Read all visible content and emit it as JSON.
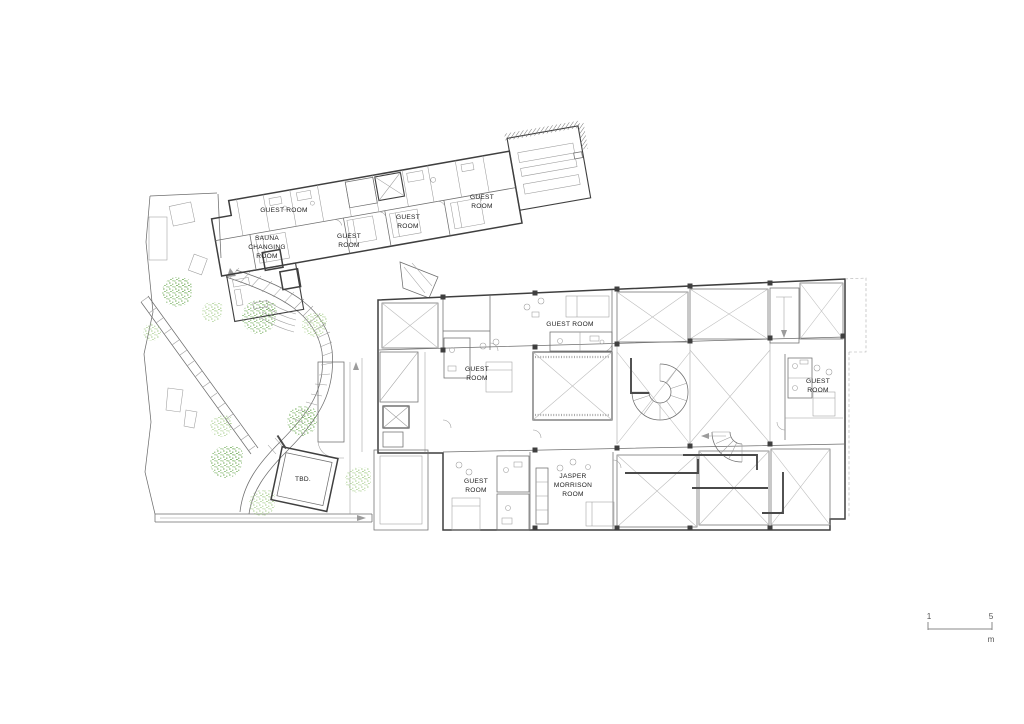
{
  "palette": {
    "wall": "#3f3f3f",
    "medium": "#6e6e6e",
    "light": "#9c9c9c",
    "brace": "#bdbdbd",
    "tree_mid": "#74ae5c",
    "tree_light": "#a9cf8f",
    "text": "#1c1c1c",
    "scale": "#555555"
  },
  "room_labels": [
    {
      "id": "upper-guest-room-1",
      "lines": [
        "GUEST ROOM"
      ]
    },
    {
      "id": "sauna-changing-room",
      "lines": [
        "SAUNA",
        "CHANGING",
        "ROOM"
      ]
    },
    {
      "id": "upper-guest-room-2",
      "lines": [
        "GUEST",
        "ROOM"
      ]
    },
    {
      "id": "upper-guest-room-3",
      "lines": [
        "GUEST",
        "ROOM"
      ]
    },
    {
      "id": "upper-guest-room-4",
      "lines": [
        "GUEST",
        "ROOM"
      ]
    },
    {
      "id": "lower-guest-room-1",
      "lines": [
        "GUEST ROOM"
      ]
    },
    {
      "id": "lower-guest-room-2",
      "lines": [
        "GUEST",
        "ROOM"
      ]
    },
    {
      "id": "lower-guest-room-3",
      "lines": [
        "GUEST",
        "ROOM"
      ]
    },
    {
      "id": "lower-guest-room-4",
      "lines": [
        "GUEST",
        "ROOM"
      ]
    },
    {
      "id": "jasper-morrison-room",
      "lines": [
        "JASPER",
        "MORRISON",
        "ROOM"
      ]
    },
    {
      "id": "tbd-pavilion",
      "lines": [
        "TBD."
      ]
    }
  ],
  "scale_bar": {
    "start": "1",
    "end": "5",
    "unit": "m"
  }
}
